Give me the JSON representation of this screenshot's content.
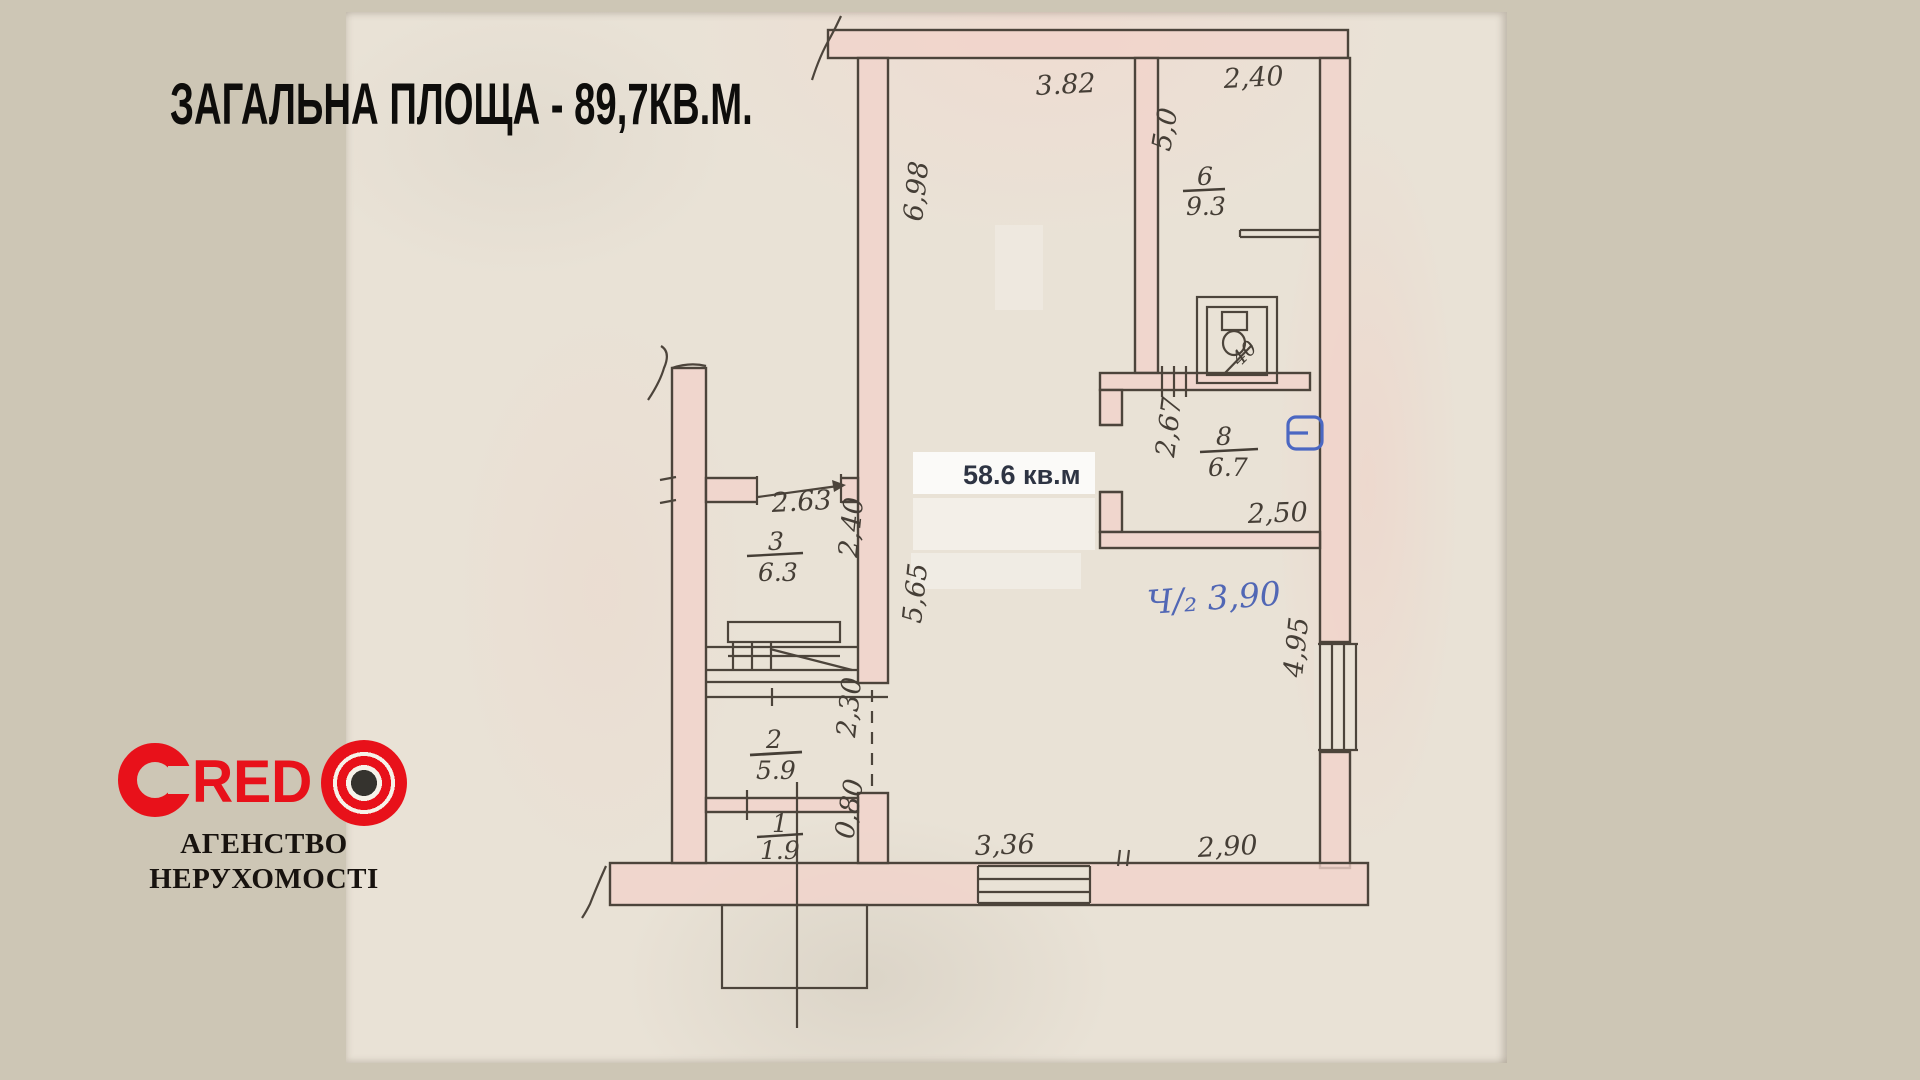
{
  "title": "ЗАГАЛЬНА ПЛОЩА - 89,7КВ.М.",
  "logo": {
    "brand_c": "C",
    "brand_red": "RED",
    "subtitle_line1": "АГЕНСТВО",
    "subtitle_line2": "НЕРУХОМОСТІ",
    "accent_color": "#e8111a"
  },
  "plan": {
    "printed_area_label": "58.6 кв.м",
    "rooms": [
      {
        "number": "3",
        "area": "6.3"
      },
      {
        "number": "2",
        "area": "5.9"
      },
      {
        "number": "1",
        "area": "1.9"
      },
      {
        "number": "6",
        "area": "9.3"
      },
      {
        "number": "8",
        "area": "6.7"
      }
    ],
    "dimensions": {
      "top_main": "3.82",
      "top_right": "2,40",
      "room6_left": "5,0",
      "main_left_upper": "6,98",
      "room3_top": "2.63",
      "room3_right": "2,40",
      "hall_left": "5,65",
      "room8_left": "2,67",
      "room8_bottom": "2,50",
      "toilet": "40",
      "blue_note": "Ч/₂ 3,90",
      "right_wall": "4,95",
      "room2_right": "2,30",
      "room1_right": "0,80",
      "bottom_left": "3,36",
      "bottom_right": "2,90"
    },
    "ink_color": "#4c443b",
    "wall_fill": "#f1d3ca",
    "blue_ink": "#5167b5"
  }
}
